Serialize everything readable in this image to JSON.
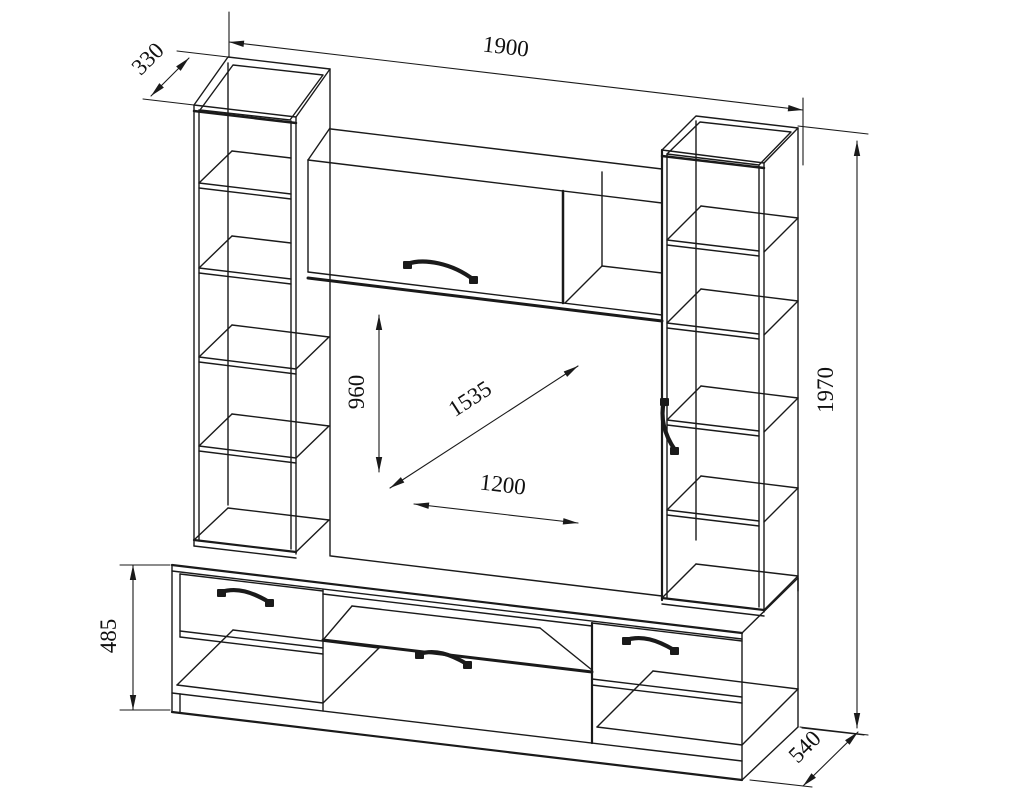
{
  "drawing": {
    "background_color": "#ffffff",
    "line_color": "#1a1a1a",
    "dimensions": {
      "overall_width": "1900",
      "tower_depth": "330",
      "overall_height": "1970",
      "base_height": "485",
      "base_depth": "540",
      "niche_height": "960",
      "niche_diagonal": "1535",
      "niche_width": "1200"
    }
  }
}
